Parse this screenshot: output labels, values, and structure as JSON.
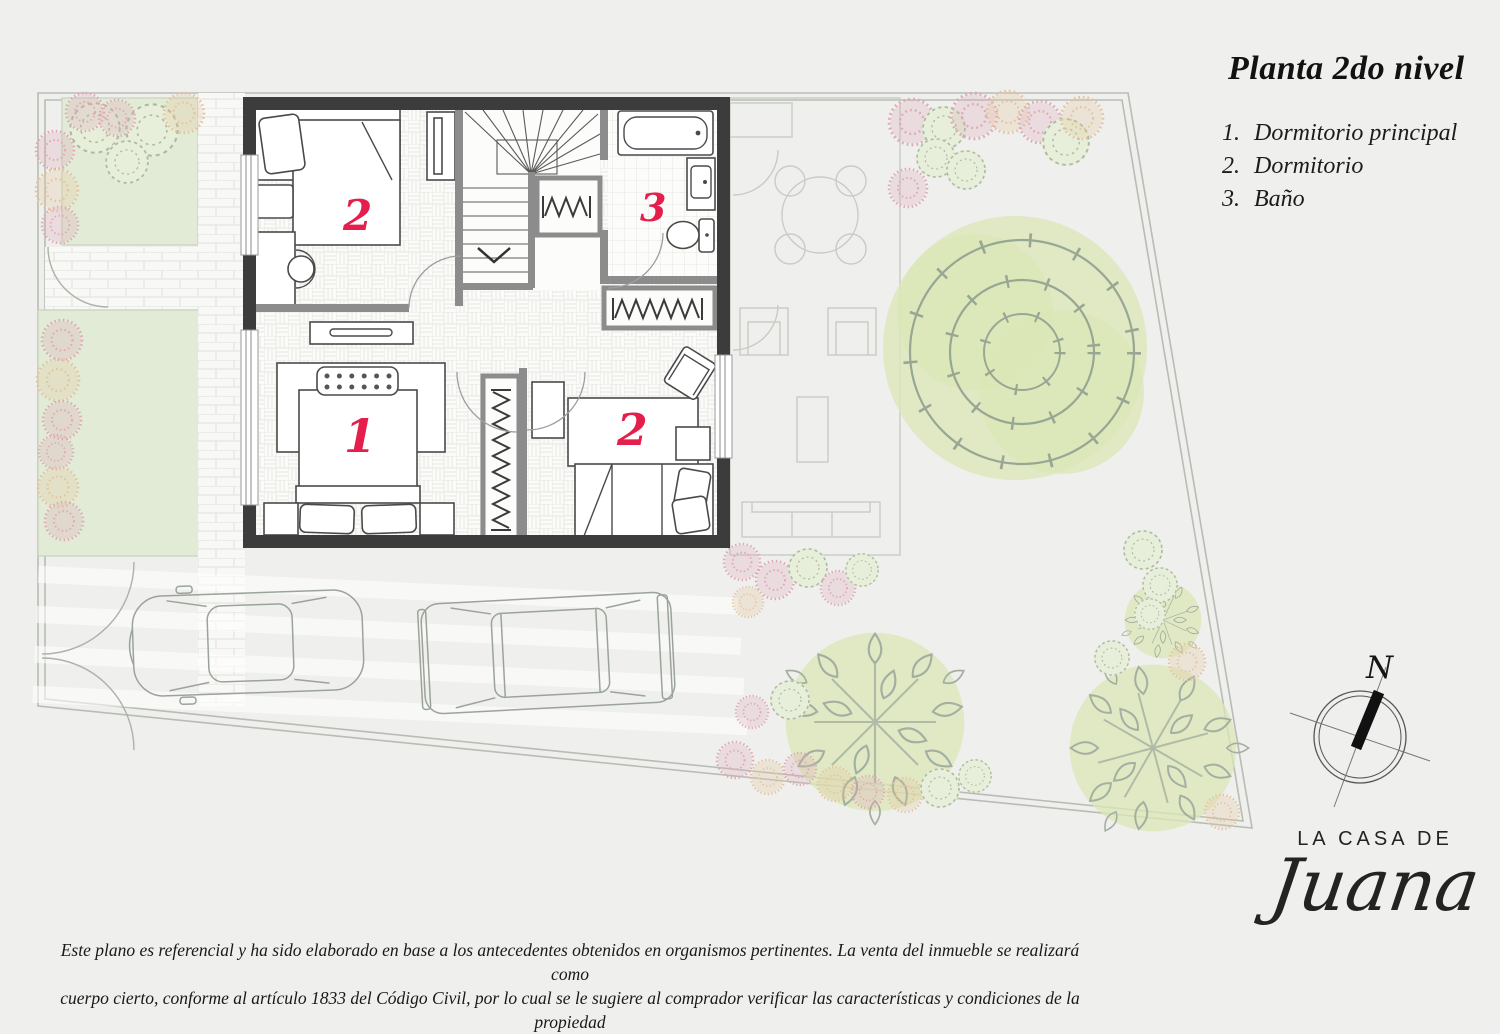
{
  "header": {
    "title": "Planta 2do nivel"
  },
  "legend": {
    "items": [
      {
        "number": "1.",
        "label": "Dormitorio principal"
      },
      {
        "number": "2.",
        "label": "Dormitorio"
      },
      {
        "number": "3.",
        "label": "Baño"
      }
    ]
  },
  "floor_plan": {
    "room_labels": {
      "master": "1",
      "bedroom_top": "2",
      "bedroom_bottom": "2",
      "bathroom": "3"
    }
  },
  "compass": {
    "north_label": "N"
  },
  "logo": {
    "line1": "LA CASA DE",
    "line2": "Juana"
  },
  "disclaimer": {
    "line1": "Este plano es referencial y ha sido elaborado en base a los antecedentes obtenidos en organismos pertinentes.  La venta del inmueble se realizará como",
    "line2": "cuerpo cierto, conforme al artículo 1833 del Código Civil, por lo cual se le sugiere al comprador verificar las características y condiciones de la propiedad"
  },
  "colors": {
    "room_label_red": "#e41f4c",
    "outer_wall": "#3c3c3c",
    "interior_wall": "#8c8c8c",
    "garden_green": "#eaf0e3",
    "garden_patch_green": "#e1ebd6",
    "background": "#efefed"
  }
}
